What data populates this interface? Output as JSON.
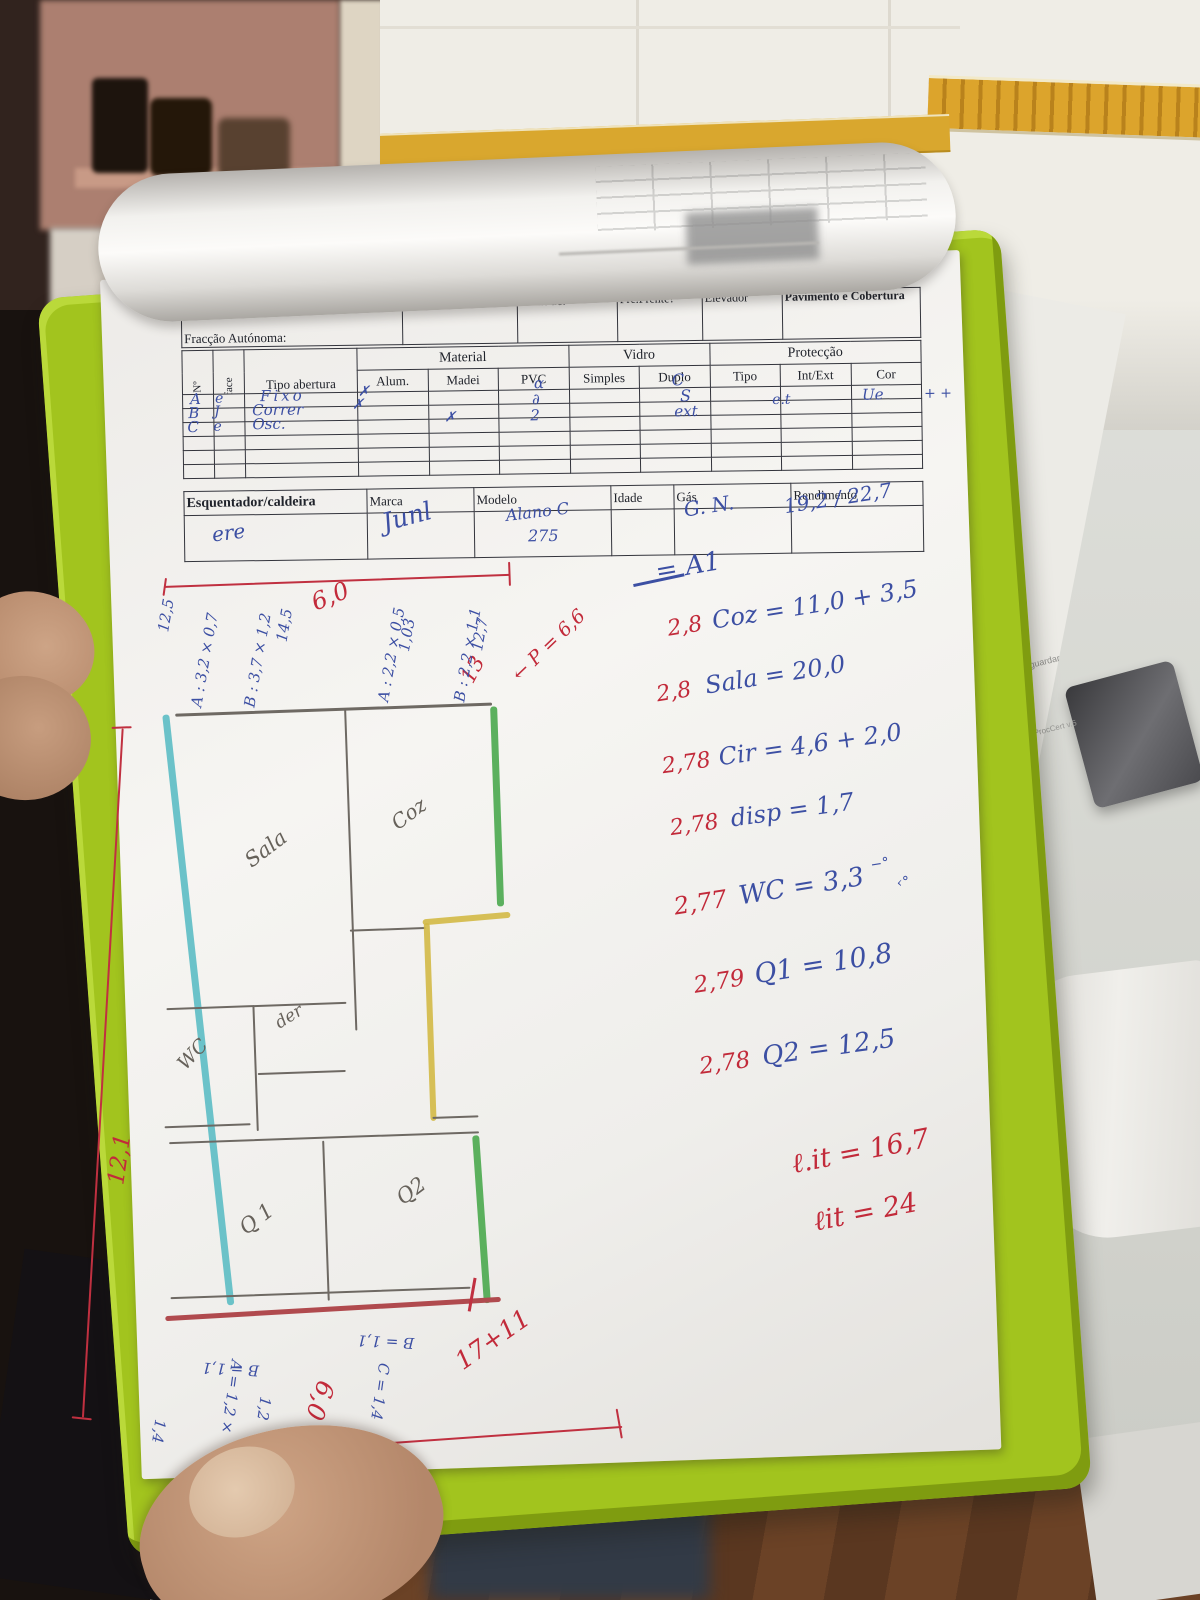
{
  "form": {
    "header": {
      "handwritten": "Bucah Olago",
      "fraccao": "Fracção Autónoma:",
      "ano": "Ano de Const:",
      "altitude": "Altitude:",
      "pre_frente": "Pré.Frente?",
      "elevador": "Elevador",
      "pavimento": "Pavimento e Cobertura"
    },
    "table": {
      "no": "Nº",
      "face": "face",
      "tipo_abertura": "Tipo abertura",
      "material": "Material",
      "vidro": "Vidro",
      "proteccao": "Protecção",
      "alum": "Alum.",
      "madei": "Madei",
      "pvc": "PVC",
      "simples": "Simples",
      "duplo": "Duplo",
      "tipo": "Tipo",
      "int_ext": "Int/Ext",
      "cor": "Cor",
      "rows": [
        {
          "no": "A",
          "face": "e",
          "tipo": "Fixo",
          "alum": "✗",
          "simples": "α",
          "prot": "C"
        },
        {
          "no": "B",
          "face": "J",
          "tipo": "Correr",
          "alum": "✗",
          "simples": "∂",
          "prot": "S",
          "int_ext": "e.t",
          "cor": "Ue"
        },
        {
          "no": "C",
          "face": "e",
          "tipo": "Osc.",
          "pvc": "✗",
          "simples": "2",
          "prot": "ext"
        }
      ],
      "margin_marks": "+ +"
    },
    "heater": {
      "label": "Esquentador/caldeira",
      "marca": "Marca",
      "modelo": "Modelo",
      "idade": "Idade",
      "gas": "Gás",
      "rendimento": "Rendimento",
      "hw_name": "ere",
      "hw_marca": "Junl",
      "hw_modelo": "Alano C",
      "hw_modelo2": "275",
      "hw_gas": "G. N.",
      "hw_rend": "19,2 / 22,7"
    }
  },
  "calc": {
    "heading": "= A1",
    "lines": [
      {
        "coef": "2,8",
        "body": "Coz = 11,0 + 3,5"
      },
      {
        "coef": "2,8",
        "body": "Sala = 20,0"
      },
      {
        "coef": "2,78",
        "body": "Cir = 4,6 + 2,0"
      },
      {
        "coef": "2,78",
        "body": "disp = 1,7"
      },
      {
        "coef": "2,77",
        "body": "WC = 3,3",
        "sup": "−°",
        "sub": "‹°"
      },
      {
        "coef": "2,79",
        "body": "Q1 = 10,8"
      },
      {
        "coef": "2,78",
        "body": "Q2 = 12,5"
      }
    ],
    "totals": [
      "ℓ.it = 16,7",
      "ℓit = 24"
    ]
  },
  "plan": {
    "rooms": {
      "sala": "Sala",
      "coz": "Coz",
      "wc": "WC",
      "desp": "der",
      "q1": "Q1",
      "q2": "Q2"
    },
    "dims": {
      "top": "6,0",
      "left": "12,1",
      "r13": "13",
      "p": "← P = 6,6",
      "bottom_sum": "17+11",
      "bottom": "6,0"
    },
    "side_notes": [
      "12,5",
      "A : 3,2 × 0,7",
      "B : 3,7 × 1,2",
      "14,5",
      "A : 2,2 × 0,5",
      "1,03",
      "B : 2,2 × 1,1",
      "12,7"
    ],
    "bottom_notes": [
      "B = 1,1",
      "B = 1,1",
      "C = 1,4",
      "A = 1,2 ×",
      "1,2",
      "1,4"
    ]
  },
  "background": {
    "faint_text1": "ambos guardar",
    "faint_text2": "MobileDocProcCert v.5"
  }
}
